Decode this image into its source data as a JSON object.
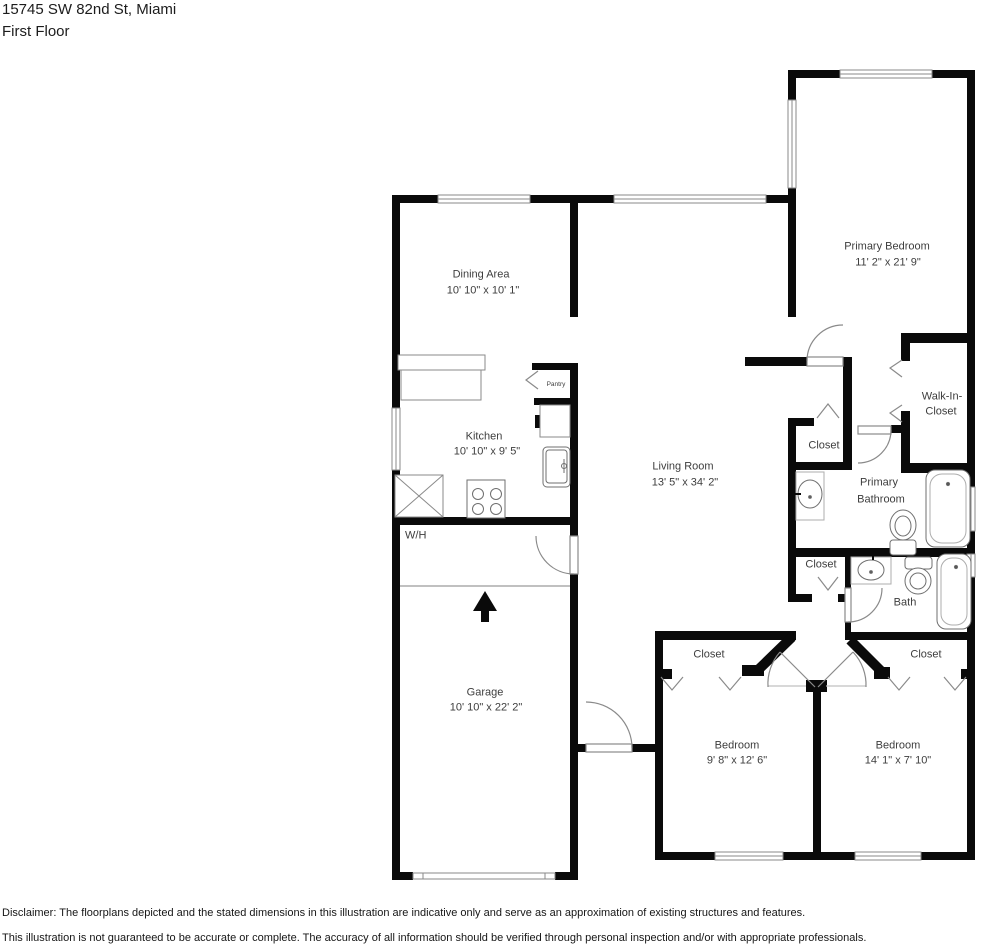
{
  "header": {
    "address": "15745 SW 82nd St, Miami",
    "floor": "First Floor"
  },
  "rooms": {
    "dining": {
      "name": "Dining Area",
      "dims": "10' 10\" x 10' 1\""
    },
    "kitchen": {
      "name": "Kitchen",
      "dims": "10' 10\" x 9' 5\""
    },
    "pantry": {
      "name": "Pantry"
    },
    "water_heater": {
      "name": "W/H"
    },
    "garage": {
      "name": "Garage",
      "dims": "10' 10\" x 22' 2\""
    },
    "living": {
      "name": "Living Room",
      "dims": "13' 5\" x 34' 2\""
    },
    "primary_bedroom": {
      "name": "Primary Bedroom",
      "dims": "11' 2\" x 21' 9\""
    },
    "walk_in_closet": {
      "line1": "Walk-In-",
      "line2": "Closet"
    },
    "hall_closet": {
      "name": "Closet"
    },
    "primary_bathroom": {
      "line1": "Primary",
      "line2": "Bathroom"
    },
    "linen_closet": {
      "name": "Closet"
    },
    "bath": {
      "name": "Bath"
    },
    "bedroom_left_closet": {
      "name": "Closet"
    },
    "bedroom_right_closet": {
      "name": "Closet"
    },
    "bedroom_left": {
      "name": "Bedroom",
      "dims": "9' 8\" x 12' 6\""
    },
    "bedroom_right": {
      "name": "Bedroom",
      "dims": "14' 1\" x 7' 10\""
    }
  },
  "disclaimer": {
    "line1": "Disclaimer: The floorplans depicted and the stated dimensions in this illustration are indicative only and serve as an approximation of existing structures and features.",
    "line2": "This illustration is not guaranteed to be accurate or complete. The accuracy of all information should be verified through personal inspection and/or with appropriate professionals."
  },
  "colors": {
    "wall": "#0a0a0a",
    "window": "#9b9b9b",
    "fixture": "#8a8a8a",
    "text": "#3d3d3d"
  }
}
